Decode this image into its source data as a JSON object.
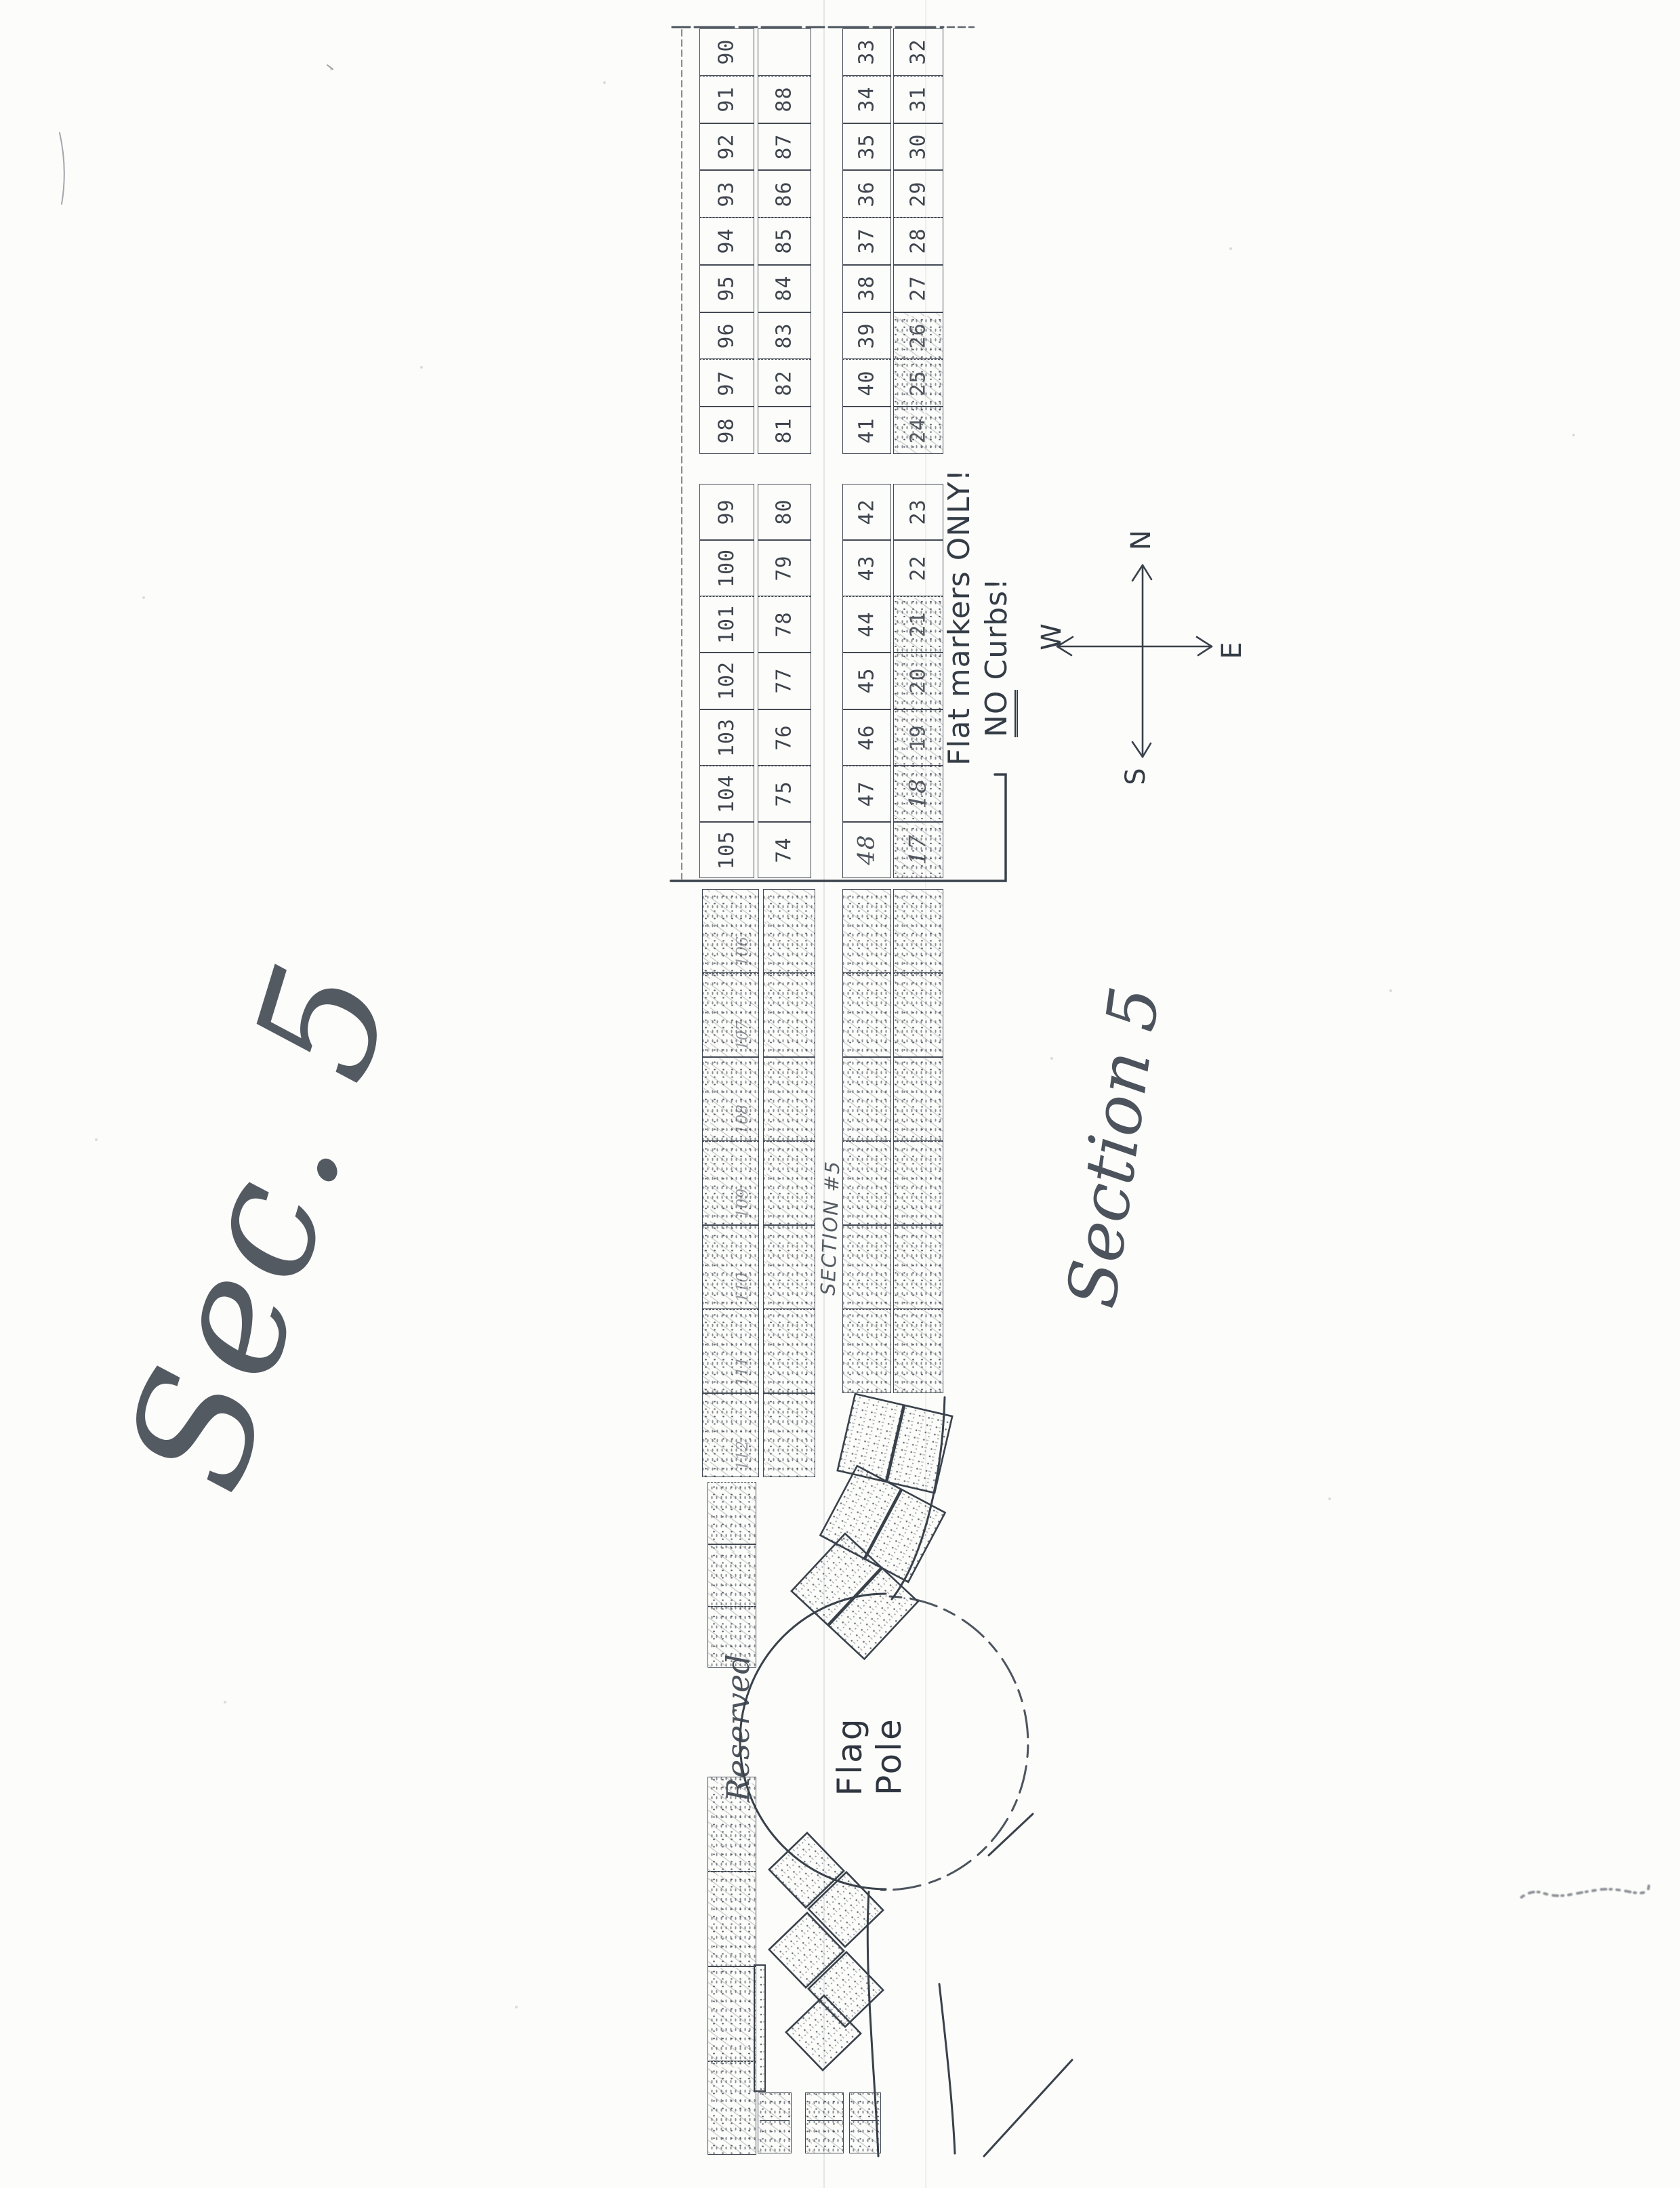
{
  "document": {
    "kind": "Scanned hand-drawn cemetery section plot map",
    "big_script_label": "Sec. 5",
    "section_script_label": "Section 5",
    "walkway_label": "SECTION #5",
    "note": {
      "line1": "Flat markers ONLY!",
      "no_word": "NO",
      "line2_rest": " Curbs!"
    },
    "reserved_label": "Reserved",
    "flag_pole": {
      "line1": "Flag",
      "line2": "Pole"
    },
    "compass": {
      "north": "N",
      "south": "S",
      "east": "E",
      "west": "W"
    },
    "handwritten_plot_48": "48"
  },
  "grid": {
    "new_section": {
      "col1_above_path": [
        "90",
        "91",
        "92",
        "93",
        "94",
        "95",
        "96",
        "97",
        "98"
      ],
      "col1_below_path": [
        "99",
        "100",
        "101",
        "102",
        "103",
        "104",
        "105"
      ],
      "col2_above_path": [
        "",
        "88",
        "87",
        "86",
        "85",
        "84",
        "83",
        "82",
        "81"
      ],
      "col2_below_path": [
        "80",
        "79",
        "78",
        "77",
        "76",
        "75",
        "74"
      ],
      "col3_above_path": [
        "33",
        "34",
        "35",
        "36",
        "37",
        "38",
        "39",
        "40",
        "41"
      ],
      "col3_below_path": [
        "42",
        "43",
        "44",
        "45",
        "46",
        "47",
        "48"
      ],
      "col4_above_path": [
        "32",
        "31",
        "30",
        "29",
        "28",
        "27",
        "26",
        "25",
        "24"
      ],
      "col4_below_path": [
        "23",
        "22",
        "21",
        "20",
        "19",
        "18",
        "17"
      ],
      "scribbled_plots": [
        "26",
        "25",
        "24",
        "21",
        "20",
        "19",
        "18",
        "17"
      ],
      "handwritten_plots": [
        "48",
        "18",
        "17"
      ]
    },
    "old_section": {
      "col1_faint_numbers": [
        "106",
        "107",
        "108",
        "109",
        "110",
        "111",
        "112"
      ],
      "col12_row_count": 7,
      "col34_row_count": 6
    }
  },
  "colors": {
    "ink": "#39414b",
    "paper": "#fcfcfa",
    "faint_ink": "#6a727c"
  }
}
